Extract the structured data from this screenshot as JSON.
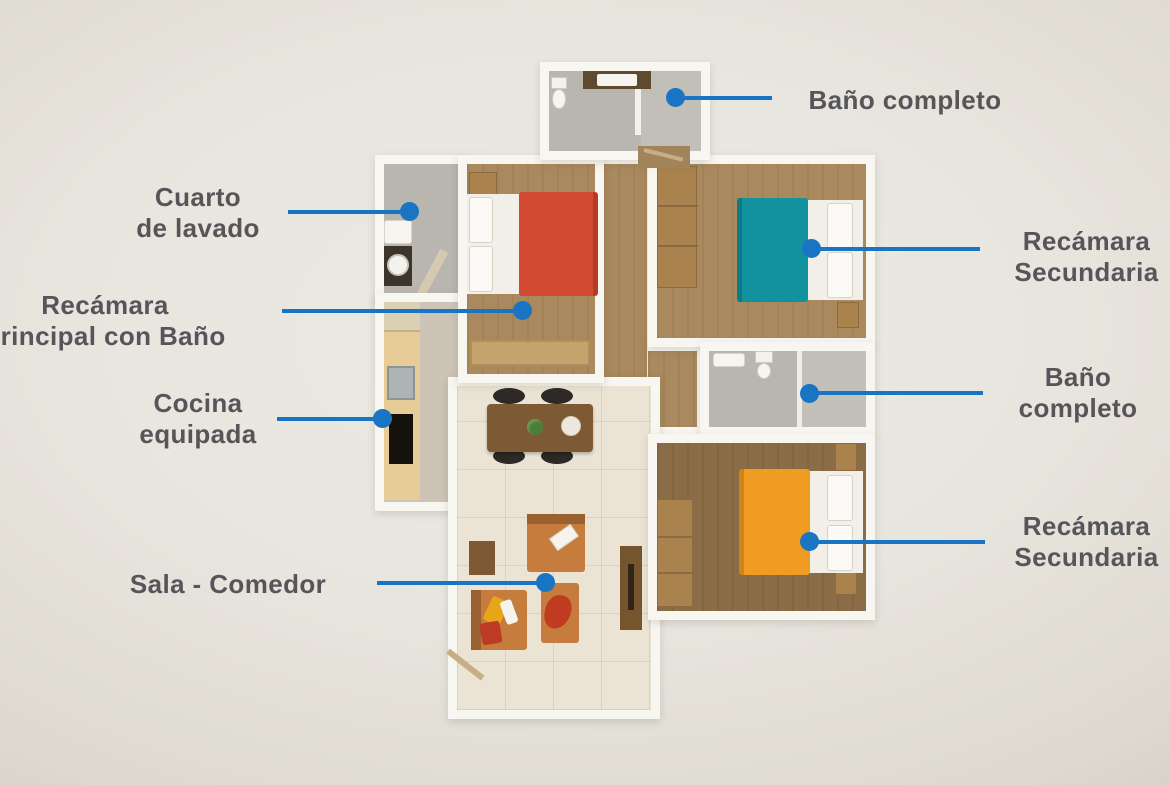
{
  "scene": {
    "accent_blue": "#1a74c4",
    "label_color": "#56565a",
    "background": "#e8e5de"
  },
  "callouts": {
    "laundry": {
      "line1": "Cuarto",
      "line2": "de lavado"
    },
    "master_bedroom": {
      "line1": "Recámara",
      "line2": "principal con Baño"
    },
    "kitchen": {
      "line1": "Cocina",
      "line2": "equipada"
    },
    "living": {
      "line1": "Sala - Comedor"
    },
    "bath_top": {
      "line1": "Baño completo"
    },
    "bedroom2_top": {
      "line1": "Recámara",
      "line2": "Secundaria"
    },
    "bath_right": {
      "line1": "Baño",
      "line2": "completo"
    },
    "bedroom2_bottom": {
      "line1": "Recámara",
      "line2": "Secundaria"
    }
  },
  "floorplan": {
    "wall_color": "#f8f6f1",
    "wood_floor": "#a9895d",
    "wood_floor_dark": "#8a6c46",
    "tile_floor": "#b9b6b0",
    "living_floor": "#ebe4d5",
    "bed_colors": {
      "master": "#d24a31",
      "secondary_top": "#12929e",
      "secondary_bottom": "#f09c22"
    }
  }
}
